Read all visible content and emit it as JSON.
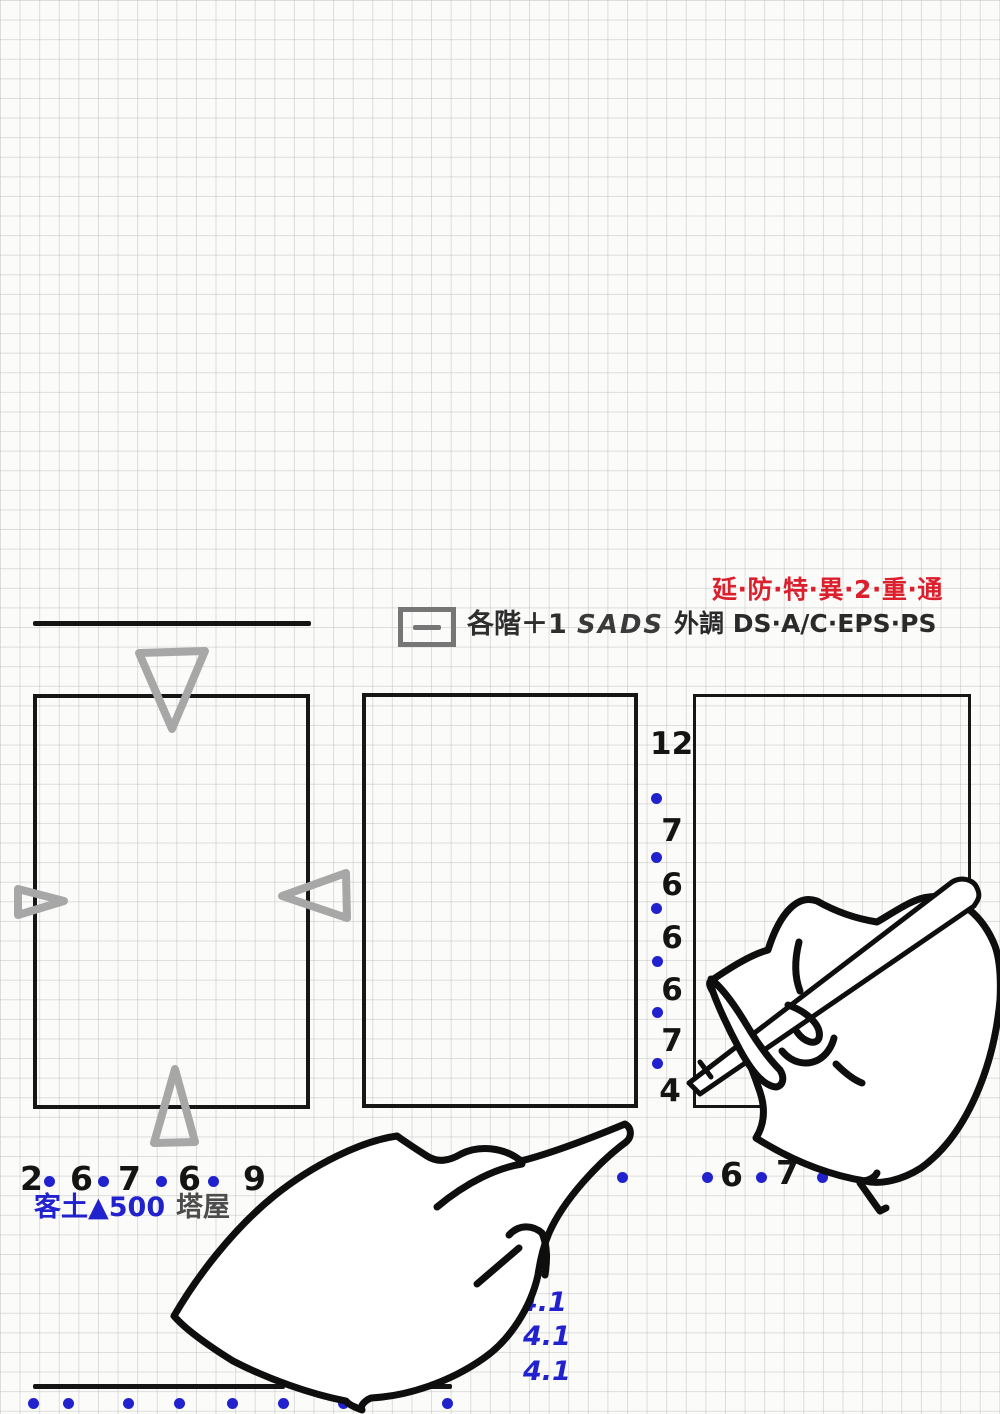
{
  "sheet": {
    "description": "hand-drawn architectural sketch on grid paper with two cartoon hands",
    "width": 1000,
    "height": 1414
  },
  "colors": {
    "blue": "#2121cd",
    "red": "#dc1f2d",
    "ink": "#141414",
    "gray_marker": "#a7a7a7",
    "dark_gray": "#4c4c4c"
  },
  "header": {
    "red_note": "延·防·特·異·2·重·通",
    "legend_symbol": "一",
    "floor_note": "各階＋1",
    "duct_note": "SADS",
    "outdoor_note": "外調 DS·A/C·EPS·PS"
  },
  "dimension_column": {
    "values": [
      "12",
      "7",
      "6",
      "6",
      "6",
      "7",
      "4"
    ]
  },
  "bottom_left_dims": {
    "values": [
      "2",
      "6",
      "7",
      "6",
      "9"
    ]
  },
  "bottom_right_dims": {
    "values": [
      "6",
      "7"
    ]
  },
  "height_notes": {
    "values": [
      "4.1",
      "4.1",
      "4.1"
    ]
  },
  "soil_note": "客土▲500",
  "tower_note": "塔屋"
}
